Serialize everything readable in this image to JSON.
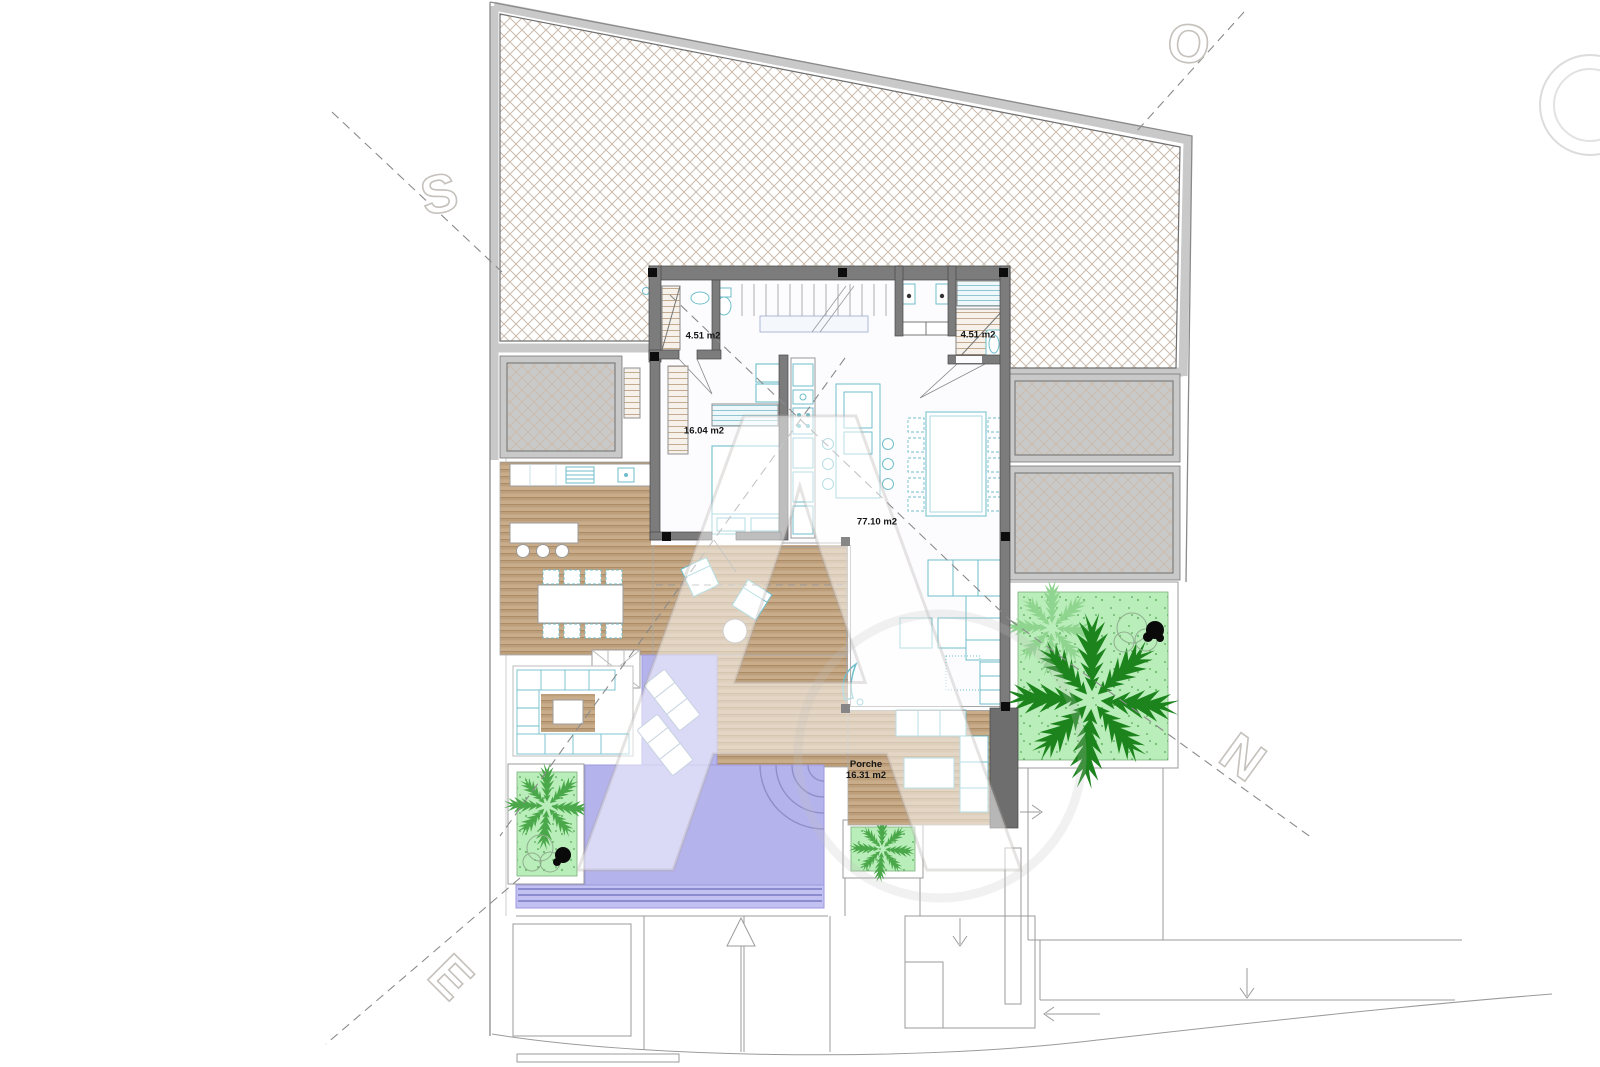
{
  "plan": {
    "rooms": {
      "bath_left": {
        "area_label": "4.51 m2"
      },
      "bath_right": {
        "area_label": "4.51 m2"
      },
      "bedroom": {
        "area_label": "16.04 m2"
      },
      "living": {
        "area_label": "77.10 m2"
      },
      "porch": {
        "name": "Porche",
        "area_label": "16.31 m2"
      }
    }
  },
  "watermark": {
    "center_letter": "A",
    "corner_letters": {
      "top_left": "S",
      "top_right": "O",
      "right": "N",
      "bottom_left": "E"
    }
  },
  "colors": {
    "wall": "#7c7c7c",
    "band": "#c9c9c9",
    "deck_base": "#c9ad8b",
    "pool": "#b5b3ec",
    "pool_line": "#8b8bd0",
    "garden": "#b9edb9",
    "palm_dark": "#1d841d",
    "palm_mid": "#4aa84a",
    "palm_light": "#8fd48f",
    "teal": "#6fbecb",
    "line_gray": "#9b9b9b",
    "label": "#151515"
  }
}
